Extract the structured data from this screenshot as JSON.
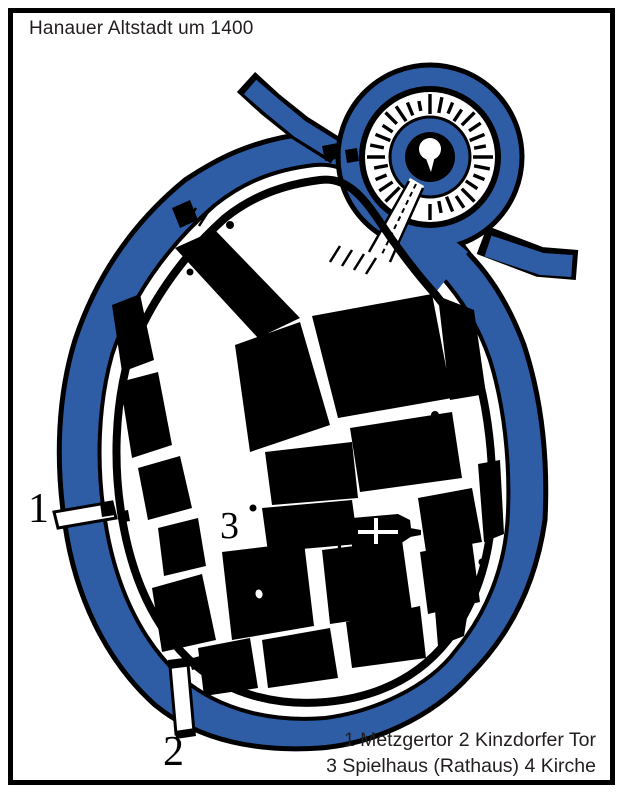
{
  "title": "Hanauer Altstadt um 1400",
  "legend": {
    "line1": "1 Metzgertor 2 Kinzdorfer Tor",
    "line2": "3 Spielhaus (Rathaus) 4 Kirche"
  },
  "markers": {
    "m1": "1",
    "m2": "2",
    "m3": "3",
    "m4": "4"
  },
  "colors": {
    "water": "#2e5da6",
    "ink": "#000000",
    "paper": "#ffffff",
    "text": "#221e1f"
  }
}
